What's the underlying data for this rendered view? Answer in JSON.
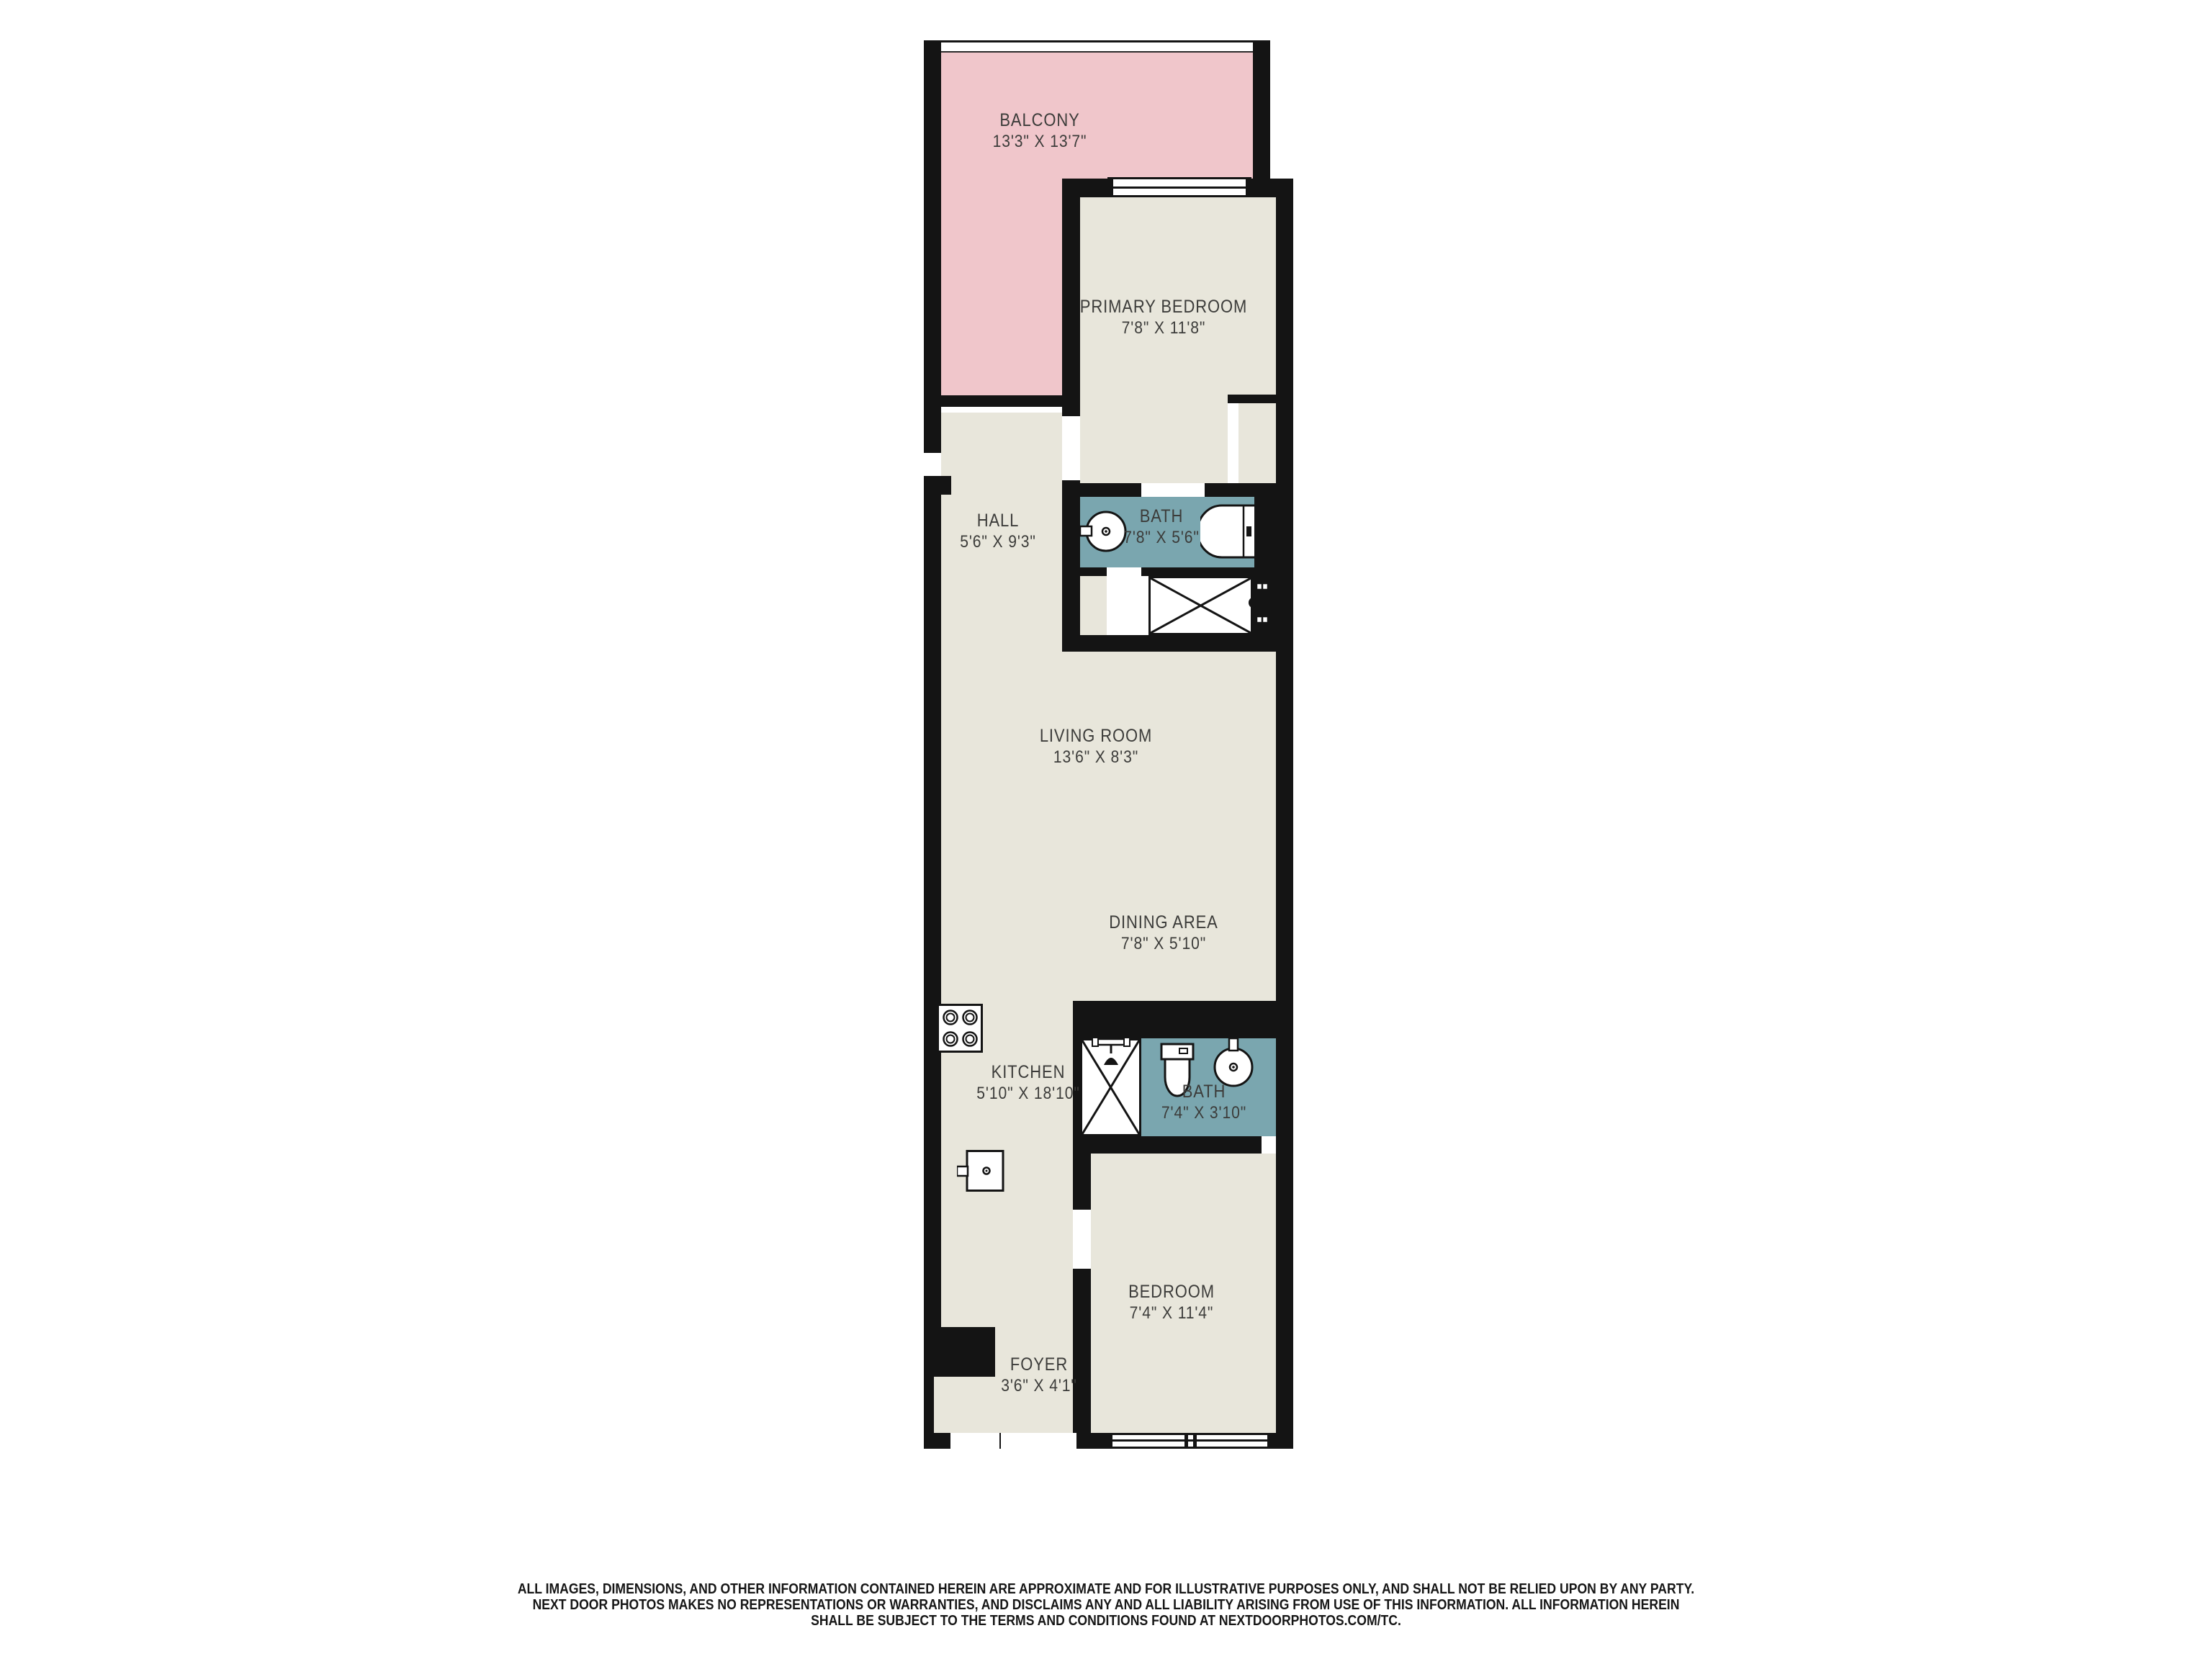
{
  "floorplan": {
    "colors": {
      "wall": "#141414",
      "floor": "#e8e6db",
      "balcony": "#f0c6cb",
      "bath": "#7aa6af",
      "label_text": "#3c3c3a"
    },
    "rooms": {
      "balcony": {
        "name": "BALCONY",
        "dims": "13'3\" X 13'7\""
      },
      "primary_bedroom": {
        "name": "PRIMARY BEDROOM",
        "dims": "7'8\" X 11'8\""
      },
      "hall": {
        "name": "HALL",
        "dims": "5'6\" X 9'3\""
      },
      "bath1": {
        "name": "BATH",
        "dims": "7'8\" X 5'6\""
      },
      "living_room": {
        "name": "LIVING ROOM",
        "dims": "13'6\" X 8'3\""
      },
      "dining_area": {
        "name": "DINING AREA",
        "dims": "7'8\" X 5'10\""
      },
      "kitchen": {
        "name": "KITCHEN",
        "dims": "5'10\" X 18'10\""
      },
      "bath2": {
        "name": "BATH",
        "dims": "7'4\" X 3'10\""
      },
      "bedroom": {
        "name": "BEDROOM",
        "dims": "7'4\" X 11'4\""
      },
      "foyer": {
        "name": "FOYER",
        "dims": "3'6\" X 4'1\""
      }
    },
    "fixtures": [
      "stove-icon",
      "kitchen-sink-icon",
      "bath-sink-icon",
      "bathtub-icon",
      "linen-closet-icon",
      "door-pull-icon",
      "shower-icon",
      "toilet-icon",
      "bath2-sink-icon",
      "window",
      "balcony-railing",
      "sliding-door-window"
    ]
  },
  "disclaimer": {
    "line1": "ALL IMAGES, DIMENSIONS, AND OTHER INFORMATION CONTAINED HEREIN ARE APPROXIMATE AND FOR ILLUSTRATIVE PURPOSES ONLY, AND SHALL NOT BE RELIED UPON BY ANY PARTY.",
    "line2": "NEXT DOOR PHOTOS MAKES NO REPRESENTATIONS OR WARRANTIES, AND DISCLAIMS ANY AND ALL LIABILITY ARISING FROM USE OF THIS INFORMATION. ALL INFORMATION HEREIN",
    "line3": "SHALL BE SUBJECT TO THE TERMS AND CONDITIONS FOUND AT NEXTDOORPHOTOS.COM/TC."
  }
}
